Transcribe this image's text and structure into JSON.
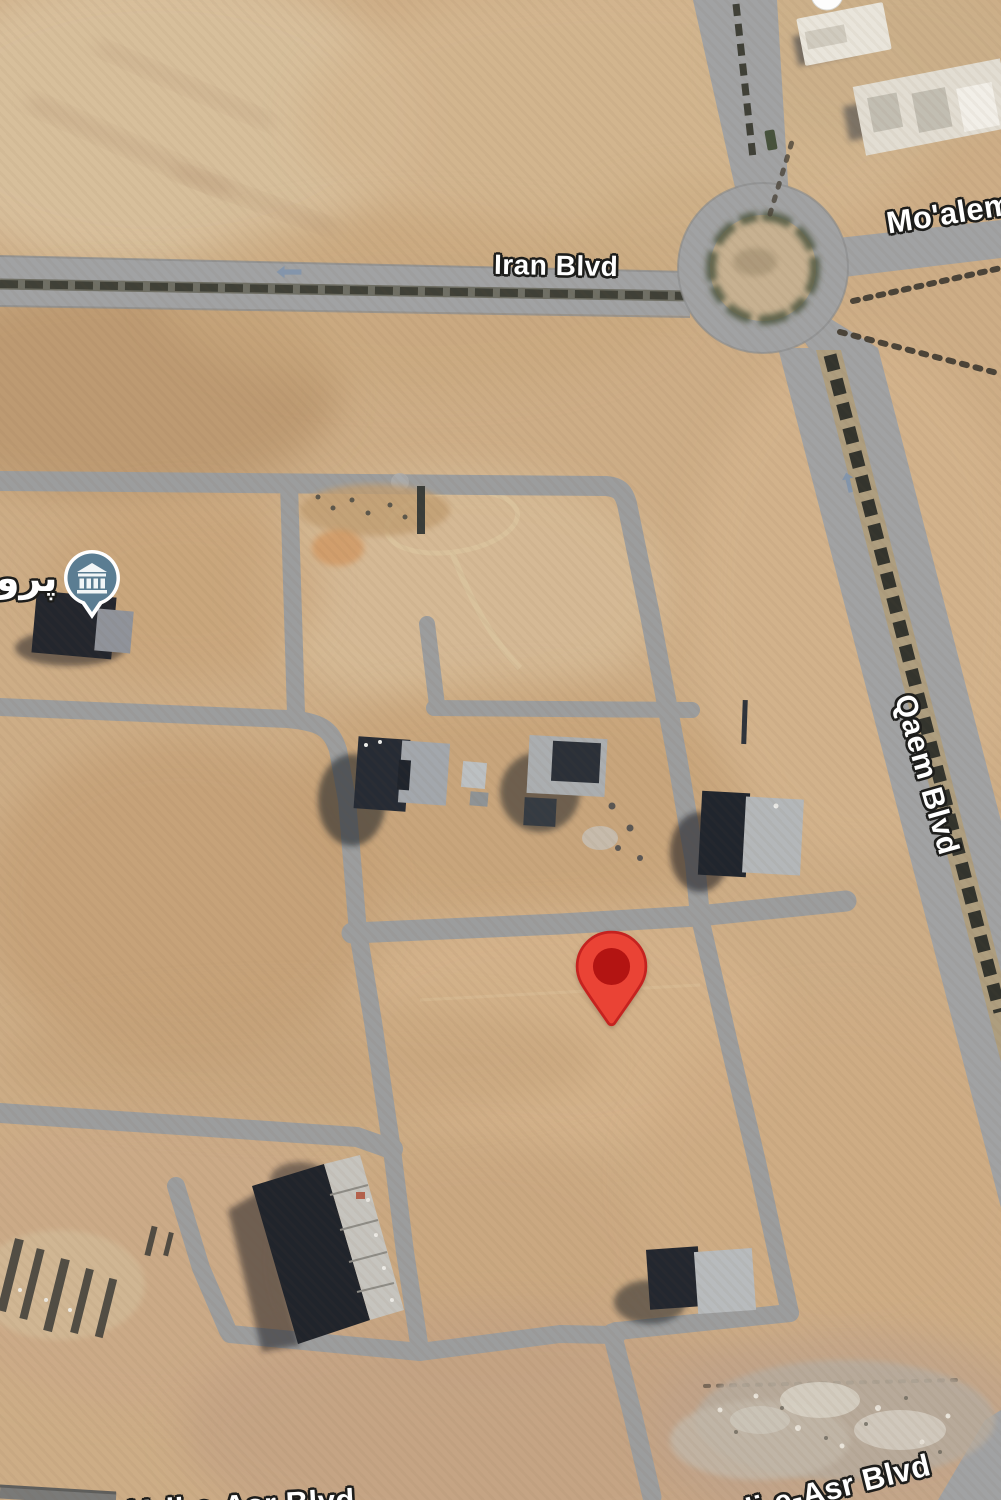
{
  "view": {
    "type": "satellite-map",
    "description": "aerial desert city view with road grid, roundabout and markers"
  },
  "labels": {
    "iran_blvd": "Iran Blvd",
    "moalem_blvd": "Mo'alem",
    "qaem_blvd": "Qaem Blvd",
    "valiasr_blvd": "Vali-e-Asr Blvd",
    "valiasr_blvd_fragment": "Vali-e-Asr Blvd",
    "poi": "پروژ"
  },
  "markers": {
    "destination_pin": {
      "kind": "red-map-pin"
    },
    "museum_poi": {
      "kind": "poi-teardrop",
      "glyph": "bank-building-icon"
    },
    "partial_pin_top": {
      "kind": "white-poi-pin-partial"
    }
  },
  "icons": {
    "oneway_left": "left-arrow",
    "oneway_up": "up-arrow"
  },
  "colors": {
    "sand": "#CDAD86",
    "road": "#A1A2A3",
    "road_minor": "#9C9D9D",
    "road_edge": "#8D8E8F",
    "median": "#3F4037",
    "median_strip": "#AE9E7F",
    "tree": "#4A4338",
    "island_ring": "#4D5640",
    "island_fill": "#C7B191",
    "pin_outer": "#EA4335",
    "pin_border": "#C5221F",
    "pin_inner": "#B31412",
    "poi_fill": "#5B7D92",
    "label_text": "#FFFFFF",
    "label_outline": "#1D1D1B",
    "arrow": "#7E93AD"
  }
}
